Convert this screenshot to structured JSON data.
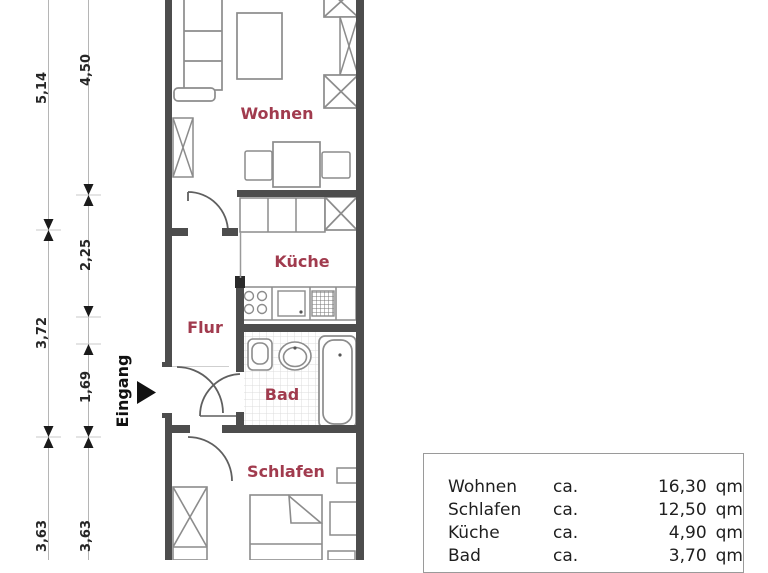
{
  "floor_plan": {
    "room_labels": {
      "wohnen": "Wohnen",
      "kueche": "Küche",
      "flur": "Flur",
      "bad": "Bad",
      "schlafen": "Schlafen"
    },
    "entrance": {
      "label": "Eingang"
    },
    "dimensions": {
      "outer": {
        "top": "5,14",
        "middle": "3,72",
        "bottom": "3,63"
      },
      "inner": {
        "top": "4,50",
        "upper_middle": "2,25",
        "lower_middle": "1,69",
        "bottom": "3,63"
      }
    },
    "colors": {
      "room_label": "#a13b4e",
      "wall": "#4d4d4d",
      "furniture": "#8c8c8c",
      "dimension_line": "#b5b5b5",
      "text": "#262626"
    }
  },
  "area_table": {
    "rows": [
      {
        "name": "Wohnen",
        "approx": "ca.",
        "value": "16,30",
        "unit": "qm"
      },
      {
        "name": "Schlafen",
        "approx": "ca.",
        "value": "12,50",
        "unit": "qm"
      },
      {
        "name": "Küche",
        "approx": "ca.",
        "value": "4,90",
        "unit": "qm"
      },
      {
        "name": "Bad",
        "approx": "ca.",
        "value": "3,70",
        "unit": "qm"
      }
    ]
  }
}
